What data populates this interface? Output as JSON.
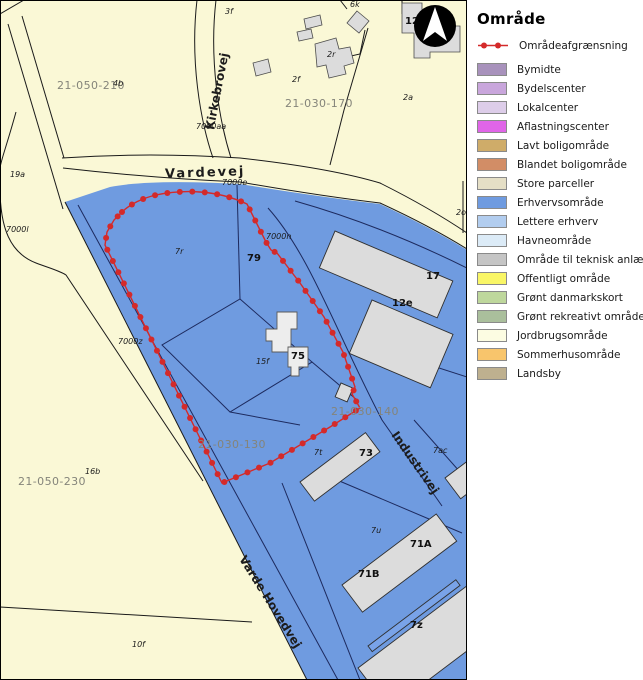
{
  "legend": {
    "title": "Område",
    "line_item": {
      "label": "Områdeafgrænsning",
      "color": "#d42a2a"
    },
    "items": [
      {
        "label": "Bymidte",
        "color": "#a892bc"
      },
      {
        "label": "Bydelscenter",
        "color": "#c9a6dc"
      },
      {
        "label": "Lokalcenter",
        "color": "#ddcde9"
      },
      {
        "label": "Aflastningscenter",
        "color": "#e065e8"
      },
      {
        "label": "Lavt boligområde",
        "color": "#cfac69"
      },
      {
        "label": "Blandet boligområde",
        "color": "#d28d66"
      },
      {
        "label": "Store parceller",
        "color": "#e5dfc6"
      },
      {
        "label": "Erhvervsområde",
        "color": "#6f9be0"
      },
      {
        "label": "Lettere erhverv",
        "color": "#b2cdef"
      },
      {
        "label": "Havneområde",
        "color": "#dcebf7"
      },
      {
        "label": "Område til teknisk anlæg",
        "color": "#c5c5c5"
      },
      {
        "label": "Offentligt område",
        "color": "#f9f666"
      },
      {
        "label": "Grønt danmarkskort",
        "color": "#bed79c"
      },
      {
        "label": "Grønt rekreativt område",
        "color": "#aabf9c"
      },
      {
        "label": "Jordbrugsområde",
        "color": "#fcfce2"
      },
      {
        "label": "Sommerhusområde",
        "color": "#f8c56c"
      },
      {
        "label": "Landsby",
        "color": "#beb08f"
      }
    ]
  },
  "map": {
    "colors": {
      "background_cream": "#faf8d6",
      "zone_blue": "#6f9be0",
      "building_gray": "#dcdcdc",
      "building_light": "#ededed",
      "boundary_red": "#d42a2a",
      "line_navy": "#1d2a5e",
      "line_black": "#1a1a1a",
      "plan_label_gray": "#84847a"
    },
    "compass": "north-arrow",
    "labels": [
      {
        "text": "21-050-210",
        "x": 57,
        "y": 89,
        "cls": "lbl-plan"
      },
      {
        "text": "4b",
        "x": 113,
        "y": 86,
        "cls": "lbl-sm"
      },
      {
        "text": "3f",
        "x": 225,
        "y": 14,
        "cls": "lbl-sm"
      },
      {
        "text": "2r",
        "x": 327,
        "y": 57,
        "cls": "lbl-sm"
      },
      {
        "text": "2f",
        "x": 292,
        "y": 82,
        "cls": "lbl-sm"
      },
      {
        "text": "21-030-170",
        "x": 285,
        "y": 107,
        "cls": "lbl-plan"
      },
      {
        "text": "2a",
        "x": 403,
        "y": 100,
        "cls": "lbl-sm"
      },
      {
        "text": "2o",
        "x": 456,
        "y": 215,
        "cls": "lbl-sm"
      },
      {
        "text": "12",
        "x": 405,
        "y": 24,
        "cls": "lbl-md"
      },
      {
        "text": "6k",
        "x": 350,
        "y": 7,
        "cls": "lbl-sm"
      },
      {
        "text": "19a",
        "x": 10,
        "y": 177,
        "cls": "lbl-sm"
      },
      {
        "text": "7000l",
        "x": 6,
        "y": 232,
        "cls": "lbl-sm"
      },
      {
        "text": "7000aa",
        "x": 196,
        "y": 129,
        "cls": "lbl-sm"
      },
      {
        "text": "7000e",
        "x": 222,
        "y": 185,
        "cls": "lbl-sm"
      },
      {
        "text": "7000n",
        "x": 266,
        "y": 239,
        "cls": "lbl-sm"
      },
      {
        "text": "7r",
        "x": 175,
        "y": 254,
        "cls": "lbl-sm"
      },
      {
        "text": "79",
        "x": 247,
        "y": 261,
        "cls": "lbl-md"
      },
      {
        "text": "7000z",
        "x": 118,
        "y": 344,
        "cls": "lbl-sm"
      },
      {
        "text": "12e",
        "x": 392,
        "y": 306,
        "cls": "lbl-md"
      },
      {
        "text": "17",
        "x": 426,
        "y": 279,
        "cls": "lbl-md"
      },
      {
        "text": "15f",
        "x": 256,
        "y": 364,
        "cls": "lbl-sm"
      },
      {
        "text": "75",
        "x": 291,
        "y": 359,
        "cls": "lbl-md"
      },
      {
        "text": "21-030-140",
        "x": 331,
        "y": 415,
        "cls": "lbl-plan"
      },
      {
        "text": "21-030-130",
        "x": 198,
        "y": 448,
        "cls": "lbl-plan"
      },
      {
        "text": "7t",
        "x": 314,
        "y": 455,
        "cls": "lbl-sm"
      },
      {
        "text": "73",
        "x": 359,
        "y": 456,
        "cls": "lbl-md"
      },
      {
        "text": "21-050-230",
        "x": 18,
        "y": 485,
        "cls": "lbl-plan"
      },
      {
        "text": "16b",
        "x": 85,
        "y": 474,
        "cls": "lbl-sm"
      },
      {
        "text": "10f",
        "x": 132,
        "y": 647,
        "cls": "lbl-sm"
      },
      {
        "text": "7ac",
        "x": 433,
        "y": 453,
        "cls": "lbl-sm"
      },
      {
        "text": "7u",
        "x": 371,
        "y": 533,
        "cls": "lbl-sm"
      },
      {
        "text": "71A",
        "x": 410,
        "y": 547,
        "cls": "lbl-md"
      },
      {
        "text": "71B",
        "x": 358,
        "y": 577,
        "cls": "lbl-md"
      },
      {
        "text": "7z",
        "x": 410,
        "y": 628,
        "cls": "lbl-md"
      },
      {
        "text": "Vardevej",
        "x": 165,
        "y": 177,
        "cls": "lbl-road-main",
        "rot": -2,
        "cx": 192,
        "cy": 173
      },
      {
        "text": "Kirkebrovej",
        "x": 221,
        "y": 92,
        "cls": "lbl-road",
        "rot": -79,
        "cx": 221,
        "cy": 92,
        "anchor": "middle"
      },
      {
        "text": "Varde Hovedvej",
        "x": 267,
        "y": 604,
        "cls": "lbl-road",
        "rot": 58,
        "cx": 267,
        "cy": 604,
        "anchor": "middle"
      },
      {
        "text": "Industrivej",
        "x": 412,
        "y": 465,
        "cls": "lbl-road",
        "rot": 55,
        "cx": 412,
        "cy": 465,
        "anchor": "middle"
      }
    ]
  }
}
